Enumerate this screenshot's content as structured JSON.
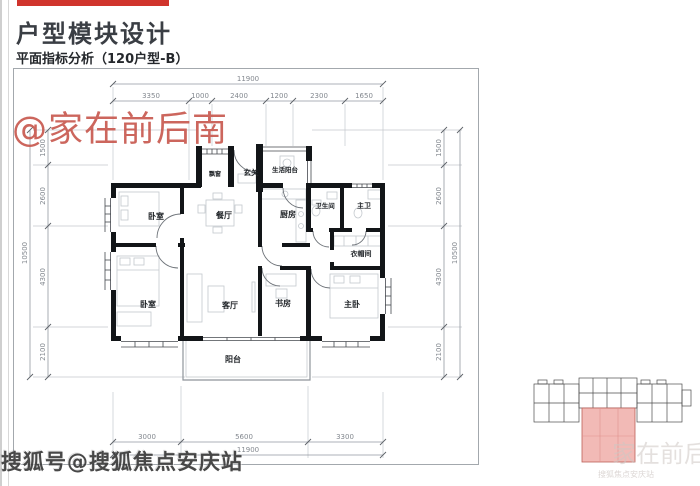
{
  "header": {
    "title": "户型模块设计",
    "subtitle": "平面指标分析（120户型-B）",
    "accent_color": "#d0342c"
  },
  "watermarks": {
    "red_handle": "@家在前后南",
    "sohu_footer": "搜狐号@搜狐焦点安庆站",
    "faint_corner": "家在前后南",
    "faint_corner_sub": "搜狐焦点安庆站"
  },
  "floor_plan": {
    "rooms": [
      {
        "label": "飘窗"
      },
      {
        "label": "玄关"
      },
      {
        "label": "生活阳台"
      },
      {
        "label": "卧室"
      },
      {
        "label": "餐厅"
      },
      {
        "label": "厨房"
      },
      {
        "label": "卫生间"
      },
      {
        "label": "主卫"
      },
      {
        "label": "衣帽间"
      },
      {
        "label": "卧室"
      },
      {
        "label": "客厅"
      },
      {
        "label": "书房"
      },
      {
        "label": "主卧"
      },
      {
        "label": "阳台"
      }
    ],
    "dimensions": {
      "top": {
        "total": "11900",
        "segments": [
          "3350",
          "1000",
          "2400",
          "1200",
          "2300",
          "1650"
        ]
      },
      "bottom": {
        "total": "11900",
        "segments": [
          "3000",
          "5600",
          "3300"
        ]
      },
      "left": {
        "total": "10500",
        "segments": [
          "1500",
          "2600",
          "4300",
          "2100"
        ]
      },
      "right": {
        "total": "10500",
        "segments": [
          "1500",
          "2600",
          "4300",
          "2100"
        ]
      }
    }
  },
  "key_plan": {
    "highlight_color": "#f2bab6"
  }
}
